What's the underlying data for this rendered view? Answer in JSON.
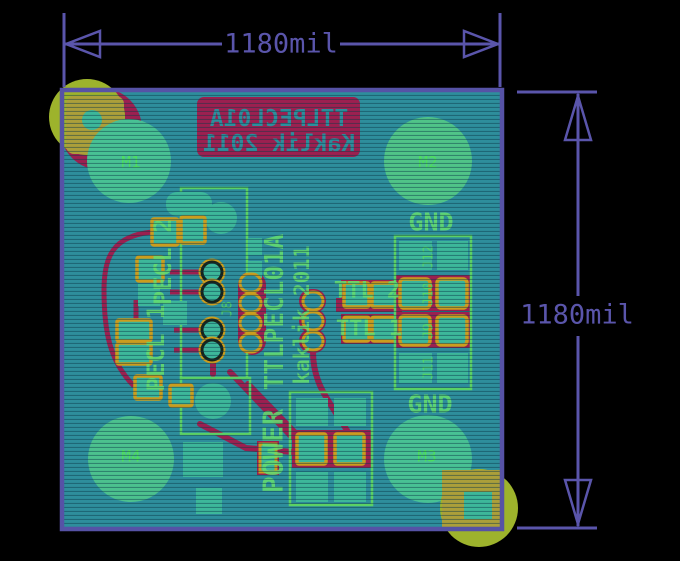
{
  "view": {
    "type": "pcb-gerber-render",
    "background": "#000000"
  },
  "colors": {
    "dimension": "#5a55ab",
    "board_fill": "#2e8e9c",
    "board_outline": "#5652a6",
    "copper_bottom": "#9c2050",
    "pad_fill": "#3db79a",
    "pad_ring": "#cb9d1e",
    "silkscreen": "#5bd165",
    "drill_marker": "#9db32c"
  },
  "dimensions": {
    "width_label": "1180mil",
    "height_label": "1180mil"
  },
  "board": {
    "silkscreen_block": {
      "line1": "TTLPECL01A",
      "line2": "Kaklik 2011"
    },
    "mount_holes": [
      {
        "label": "M1"
      },
      {
        "label": "M2"
      },
      {
        "label": "M3"
      },
      {
        "label": "M4"
      }
    ],
    "labels": {
      "gnd_top": "GND",
      "gnd_bottom": "GND",
      "pecl2": "PECL 2",
      "pecl1": "PECL 1",
      "ttl2": "TTL 2",
      "ttl1": "TTL 1",
      "power": "POWER",
      "title_vertical": "TTLPECL01A",
      "author_vertical": "kaklik 2011"
    },
    "designators": {
      "j8": "J8",
      "j9": "J9",
      "j10": "J10",
      "j11": "J11",
      "j12": "J12"
    }
  }
}
